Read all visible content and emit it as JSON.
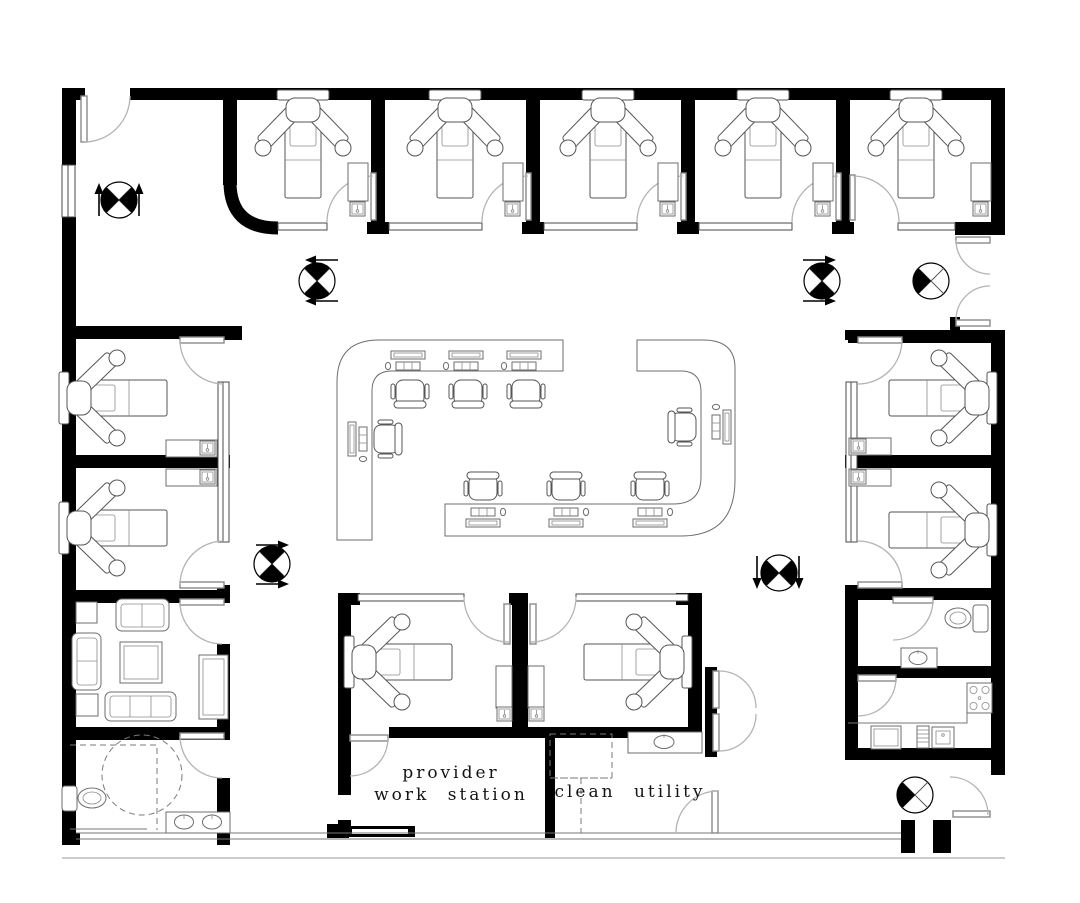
{
  "drawing": {
    "type": "architectural floor plan",
    "facility": "outpatient clinic suite",
    "background": "#ffffff",
    "line_color": "#000000"
  },
  "labels": {
    "provider_station": {
      "line1": "provider",
      "line2": "work station"
    },
    "clean_utility": "clean utility"
  },
  "rooms": [
    {
      "name": "entry-vestibule",
      "furniture": []
    },
    {
      "name": "exam-room-top-1",
      "furniture": [
        "exam-chair",
        "counter-with-sink"
      ]
    },
    {
      "name": "exam-room-top-2",
      "furniture": [
        "exam-chair",
        "counter-with-sink"
      ]
    },
    {
      "name": "exam-room-top-3",
      "furniture": [
        "exam-chair",
        "counter-with-sink"
      ]
    },
    {
      "name": "exam-room-top-4",
      "furniture": [
        "exam-chair",
        "counter-with-sink"
      ]
    },
    {
      "name": "exam-room-top-5",
      "furniture": [
        "exam-chair",
        "counter-with-sink"
      ]
    },
    {
      "name": "exam-room-left-1",
      "furniture": [
        "exam-chair",
        "counter-with-sink"
      ]
    },
    {
      "name": "exam-room-left-2",
      "furniture": [
        "exam-chair",
        "counter-with-sink"
      ]
    },
    {
      "name": "waiting-room",
      "furniture": [
        "loveseat",
        "sofa",
        "sofa-three-seat",
        "armchair-table",
        "armchair-table",
        "coffee-table",
        "console-cabinet"
      ]
    },
    {
      "name": "accessible-restroom",
      "furniture": [
        "toilet",
        "double-sink-counter",
        "wheelchair-turning-circle"
      ]
    },
    {
      "name": "exam-room-right-1",
      "furniture": [
        "exam-chair",
        "counter-with-sink"
      ]
    },
    {
      "name": "exam-room-right-2",
      "furniture": [
        "exam-chair",
        "counter-with-sink"
      ]
    },
    {
      "name": "restroom-right",
      "furniture": [
        "toilet",
        "sink-counter"
      ]
    },
    {
      "name": "break-room-kitchen",
      "furniture": [
        "range-4-burner",
        "refrigerator",
        "dishwasher",
        "sink",
        "l-counter"
      ]
    },
    {
      "name": "exam-room-bottom-left",
      "furniture": [
        "exam-chair",
        "cabinet-with-sink"
      ]
    },
    {
      "name": "exam-room-bottom-right",
      "furniture": [
        "exam-chair",
        "cabinet-with-sink"
      ]
    },
    {
      "name": "provider-work-station",
      "labeled": true
    },
    {
      "name": "clean-utility",
      "labeled": true,
      "furniture": [
        "sink-counter",
        "dashed-future-equipment"
      ]
    },
    {
      "name": "central-nurse-station",
      "furniture": [
        "curved-counter-left",
        "curved-counter-right"
      ],
      "computer_workstations": 8,
      "office_chairs": 8
    },
    {
      "name": "corridor-closet",
      "furniture": [
        "double-cabinet-doors"
      ]
    }
  ],
  "symbols": [
    {
      "name": "target-symbol-entry",
      "quadrants_filled": "east-west",
      "arrows": "up-both-sides"
    },
    {
      "name": "target-symbol-corridor-left",
      "quadrants_filled": "north-south",
      "arrows": "left-above-below"
    },
    {
      "name": "target-symbol-corridor-right",
      "quadrants_filled": "north-south",
      "arrows": "right-above-below"
    },
    {
      "name": "target-symbol-right-entry",
      "quadrants_filled": "west",
      "arrows": "none"
    },
    {
      "name": "target-symbol-mid-left",
      "quadrants_filled": "north-south",
      "arrows": "right-above-below"
    },
    {
      "name": "target-symbol-mid-right",
      "quadrants_filled": "east-west",
      "arrows": "down-both-sides"
    },
    {
      "name": "target-symbol-exit",
      "quadrants_filled": "west",
      "arrows": "none"
    }
  ],
  "doors": {
    "swing_style": "quarter-arc",
    "count": 22
  },
  "colors": {
    "walls": "#000000",
    "furniture_line": "#6e6e6e",
    "door_leaf": "#8a8a8a",
    "door_arc": "#b3b3b3",
    "text": "#141414",
    "background": "#ffffff"
  }
}
